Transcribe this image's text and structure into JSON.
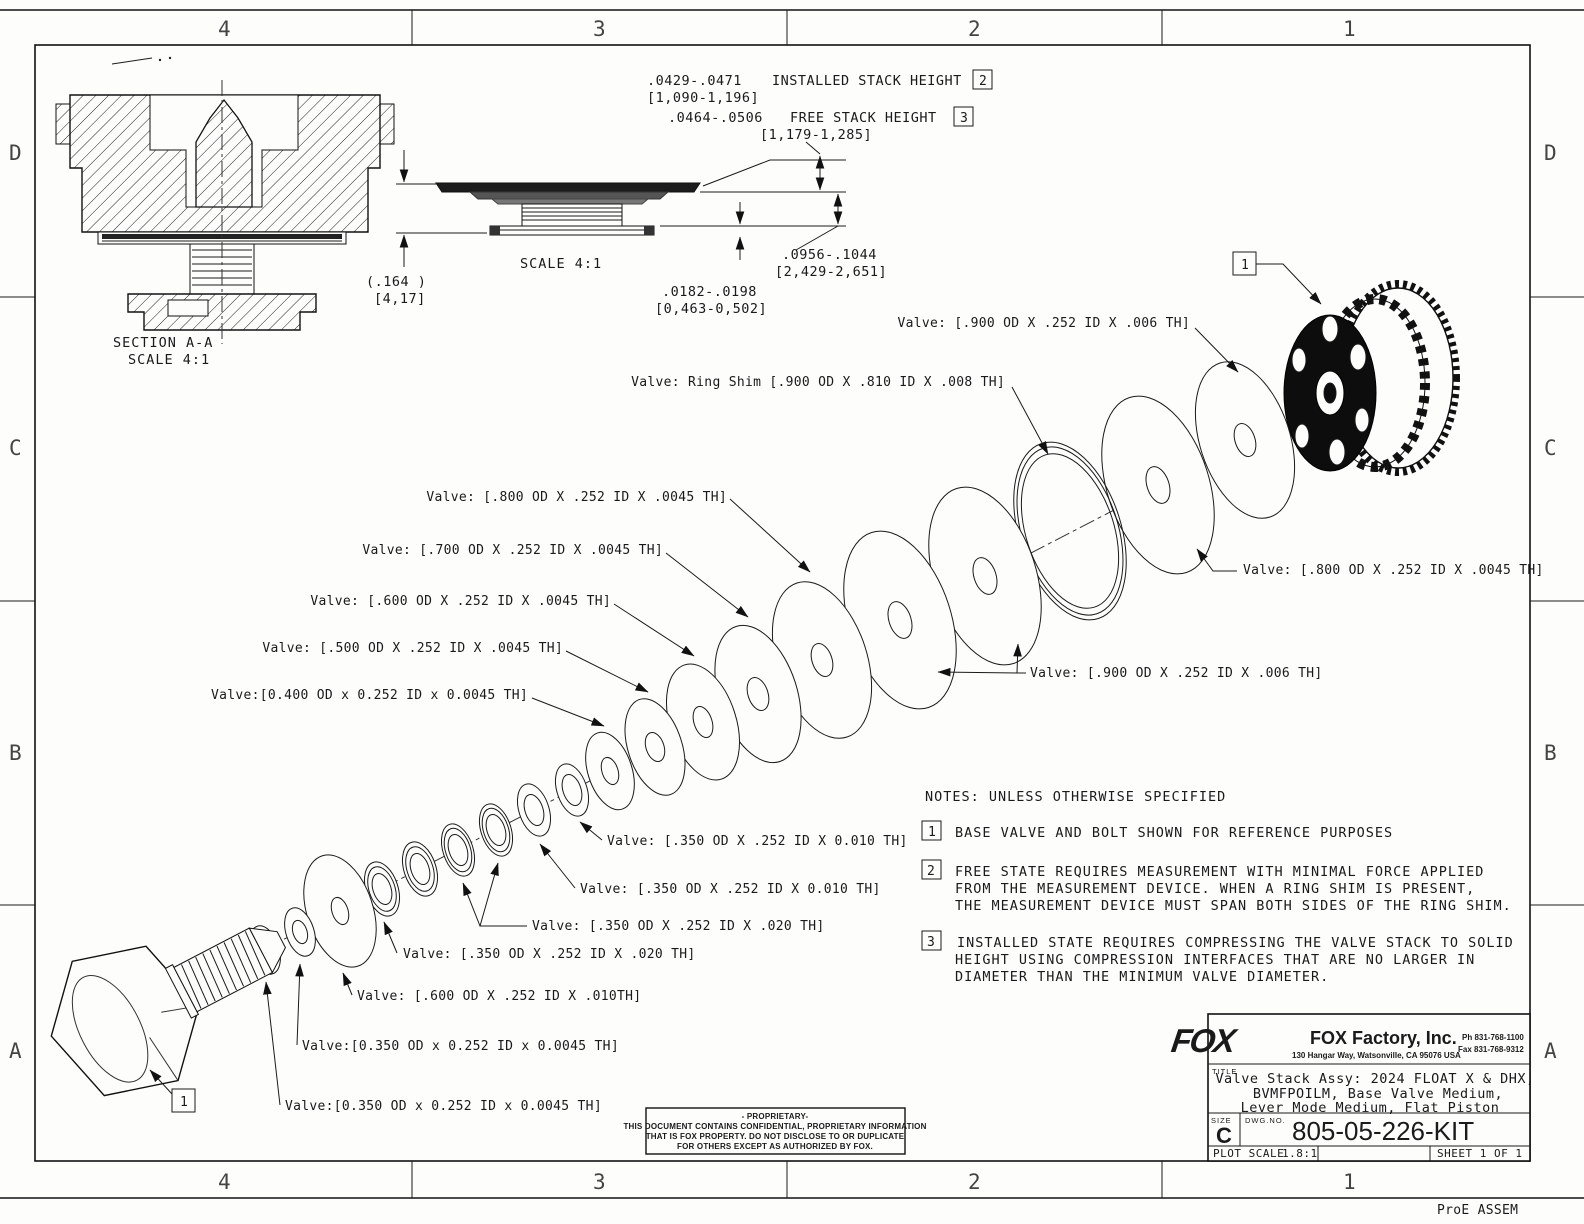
{
  "zones": {
    "c": [
      "4",
      "3",
      "2",
      "1"
    ],
    "r": [
      "D",
      "C",
      "B",
      "A"
    ]
  },
  "flags": {
    "f1": "1",
    "f2": "2",
    "f3": "3"
  },
  "dims": {
    "installed_in": ".0429-.0471",
    "installed_label": "INSTALLED STACK HEIGHT",
    "installed_mm": "[1,090-1,196]",
    "free_in": ".0464-.0506",
    "free_label": "FREE STACK HEIGHT",
    "free_mm": "[1,179-1,285]",
    "total_in": ".0956-.1044",
    "total_mm": "[2,429-2,651]",
    "plate_in": ".0182-.0198",
    "plate_mm": "[0,463-0,502]",
    "width_in": "(.164  )",
    "width_mm": "[4,17]"
  },
  "section": {
    "name": "SECTION A-A",
    "scale": "SCALE 4:1"
  },
  "detail": {
    "scale": "SCALE 4:1"
  },
  "valves": {
    "v900_top": "Valve: [.900 OD X .252 ID X .006 TH]",
    "ring_shim": "Valve: Ring Shim [.900 OD X .810 ID X .008 TH]",
    "v800_left": "Valve: [.800 OD X .252 ID X .0045 TH]",
    "v700_left": "Valve: [.700 OD X .252 ID X .0045 TH]",
    "v600_left": "Valve: [.600 OD X .252 ID X .0045 TH]",
    "v500_left": "Valve: [.500 OD X .252 ID X .0045 TH]",
    "v400_left": "Valve:[0.400 OD x 0.252 ID x 0.0045 TH]",
    "v800_right": "Valve: [.800 OD X .252 ID X .0045 TH]",
    "v900_bottom": "Valve: [.900 OD X .252 ID X .006 TH]",
    "v350_010_a": "Valve: [.350 OD X .252 ID X 0.010 TH]",
    "v350_010_b": "Valve: [.350 OD X .252 ID X 0.010 TH]",
    "v350_020_a": "Valve: [.350 OD X .252 ID X .020 TH]",
    "v350_020_b": "Valve: [.350 OD X .252 ID X .020 TH]",
    "v600_010": "Valve: [.600 OD X .252 ID X .010TH]",
    "v350_0045_a": "Valve:[0.350 OD x 0.252 ID x 0.0045 TH]",
    "v350_0045_b": "Valve:[0.350 OD x 0.252 ID x 0.0045 TH]"
  },
  "notes": {
    "header": "NOTES: UNLESS OTHERWISE SPECIFIED",
    "n1": "BASE VALVE AND BOLT SHOWN FOR REFERENCE PURPOSES",
    "n2_l1": "FREE STATE REQUIRES MEASUREMENT WITH MINIMAL FORCE APPLIED",
    "n2_l2": "FROM THE MEASUREMENT DEVICE. WHEN A RING SHIM IS PRESENT,",
    "n2_l3": "THE MEASUREMENT DEVICE MUST SPAN BOTH SIDES OF THE RING SHIM.",
    "n3_l1": "INSTALLED STATE REQUIRES COMPRESSING THE VALVE STACK TO SOLID",
    "n3_l2": "HEIGHT USING COMPRESSION INTERFACES THAT ARE NO LARGER IN",
    "n3_l3": "DIAMETER THAN THE MINIMUM VALVE DIAMETER."
  },
  "title_block": {
    "logo": "FOX",
    "company": "FOX Factory, Inc.",
    "address": "130 Hangar Way, Watsonville, CA 95076 USA",
    "phone": "Ph 831-768-1100",
    "fax": "Fax 831-768-9312",
    "title_label": "TITLE",
    "title_l1": "Valve Stack Assy: 2024 FLOAT X & DHX,",
    "title_l2": "BVMFPOILM, Base Valve Medium,",
    "title_l3": "Lever Mode Medium, Flat Piston",
    "size_label": "SIZE",
    "size": "C",
    "dwg_label": "DWG.NO.",
    "dwg_no": "805-05-226-KIT",
    "plot_scale_label": "PLOT SCALE",
    "plot_scale": "1.8:1",
    "sheet": "SHEET 1 OF 1"
  },
  "proprietary": {
    "l1": "- PROPRIETARY-",
    "l2": "THIS DOCUMENT CONTAINS CONFIDENTIAL, PROPRIETARY INFORMATION",
    "l3": "THAT IS FOX PROPERTY.  DO NOT DISCLOSE TO OR DUPLICATE",
    "l4": "FOR OTHERS EXCEPT AS AUTHORIZED BY FOX."
  },
  "footer": {
    "cad_note": "ProE ASSEM"
  }
}
